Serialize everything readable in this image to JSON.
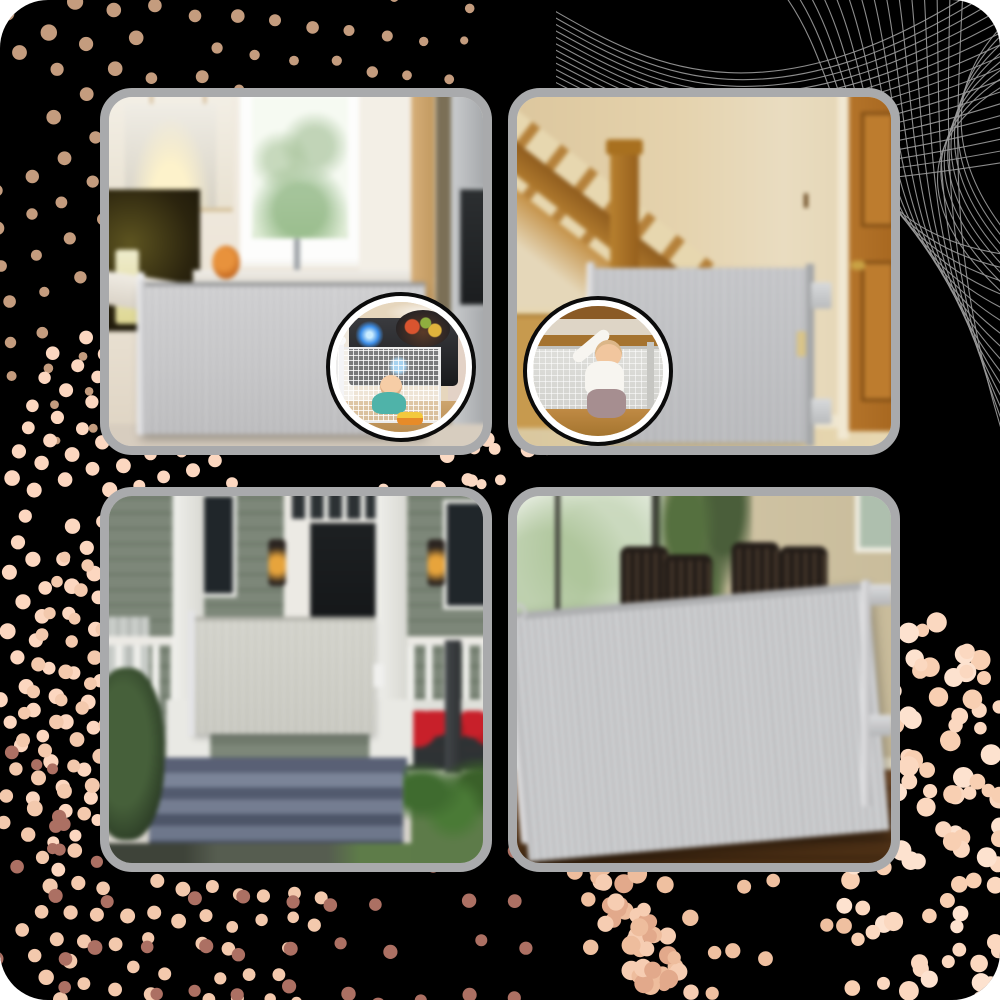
{
  "collage": {
    "title": "Retractable mesh safety gate — four-photo product collage",
    "canvas": {
      "background": "#000000",
      "corner_radius_px": 48,
      "card_border_color": "#a9aaac"
    },
    "product": {
      "name": "retractable safety gate",
      "gate_color": "#c6c7c9"
    },
    "decor": {
      "mesh_lines_color": "#9b9b9b",
      "dot_colors": [
        "#c49c7e",
        "#fcd7c0",
        "#ac7063",
        "#f6cdb2",
        "#fbd8c0"
      ]
    },
    "cards": [
      {
        "label": "Kitchen with grey retractable gate closed across entry",
        "inset_label": "Close-up: white mesh gate guarding lit gas stove, baby crawling with toy car"
      },
      {
        "label": "Hallway staircase with grey retractable gate across doorway by wooden door",
        "inset_label": "Close-up: baby reaching up at gate across bottom of stairs"
      },
      {
        "label": "Front porch with grey retractable gate across steps between columns",
        "inset_label": ""
      },
      {
        "label": "Dining room with wide grey retractable gate across opening",
        "inset_label": ""
      }
    ]
  }
}
